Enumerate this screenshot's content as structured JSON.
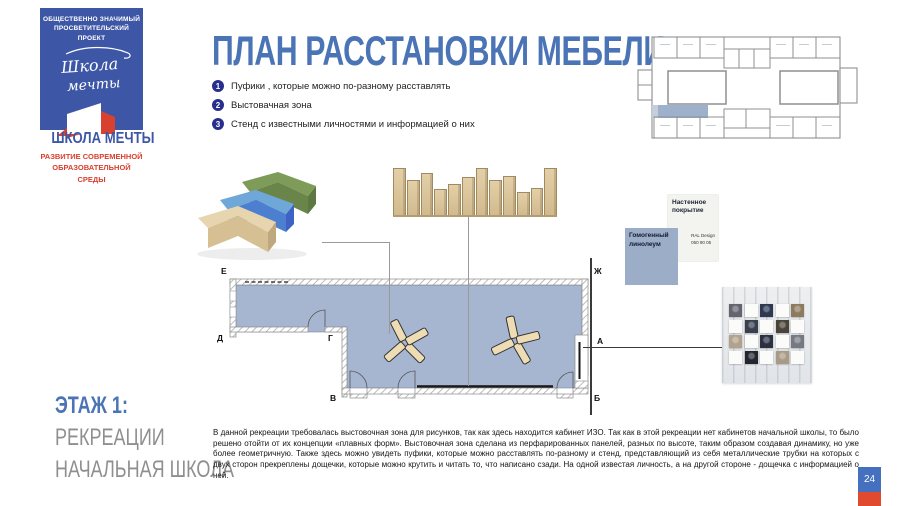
{
  "slide": {
    "page_number": "24"
  },
  "logo": {
    "project_line1": "ОБЩЕСТВЕННО ЗНАЧИМЫЙ",
    "project_line2": "ПРОСВЕТИТЕЛЬСКИЙ ПРОЕКТ",
    "script_line1": "Школа",
    "script_line2": "мечты",
    "name": "ШКОЛА МЕЧТЫ",
    "tagline_line1": "РАЗВИТИЕ СОВРЕМЕННОЙ",
    "tagline_line2": "ОБРАЗОВАТЕЛЬНОЙ СРЕДЫ"
  },
  "title": "ПЛАН РАССТАНОВКИ МЕБЕЛИ",
  "legend": {
    "items": [
      {
        "num": "1",
        "label": "Пуфики , которые можно по-разному расставлять"
      },
      {
        "num": "2",
        "label": "Выстовачная зона"
      },
      {
        "num": "3",
        "label": "Стенд с  известными личностями и информацией о них"
      }
    ]
  },
  "plan": {
    "axis_labels": {
      "E": "Е",
      "D": "Д",
      "G": "Г",
      "V": "В",
      "ZH": "Ж",
      "A": "А",
      "B": "Б"
    }
  },
  "materials": {
    "wall_covering": {
      "title": "Настенное покрытие",
      "spec_line1": "RAL Design",
      "spec_line2": "050 90 05"
    },
    "floor": {
      "title": "Гомогенный линолеум"
    }
  },
  "floor_label": {
    "floor": "ЭТАЖ 1:",
    "line1": "РЕКРЕАЦИИ",
    "line2": "НАЧАЛЬНАЯ ШКОЛА"
  },
  "description": "В данной рекреации требовалась выстовочная зона для рисунков, так как здесь находится кабинет ИЗО. Так как в этой рекреации нет кабинетов начальной школы, то было решено отойти от их концепции «плавных форм». Выстовочная зона сделана из перфарированных панелей, разных по высоте, таким образом создавая динамику, но уже более геометричную. Также здесь можно увидеть пуфики, которые можно расставлять по-разному и стенд, представляющий из себя металлические трубки на которых с двух сторон прекреплены дощечки, которые можно крутить и читать то, что написано сзади. На одной известая личность, а на другой стороне - дощечка с информацией о ней.",
  "exhibition_wall": {
    "slat_heights": [
      0.95,
      0.7,
      0.85,
      0.53,
      0.63,
      0.78,
      0.96,
      0.71,
      0.79,
      0.45,
      0.55,
      0.96
    ]
  },
  "photo_stand": {
    "tiles": [
      [
        "#63646e",
        "",
        "#2e3850",
        "",
        "#8d7b60"
      ],
      [
        "",
        "#3a3f4d",
        "",
        "#4a4438",
        ""
      ],
      [
        "#b0a28c",
        "",
        "#2c3142",
        "",
        "#757a82"
      ],
      [
        "",
        "#23262e",
        "",
        "#a89a84",
        ""
      ]
    ]
  },
  "colors": {
    "accent_blue": "#4a74b5",
    "logo_blue": "#3d57a6",
    "logo_red": "#d8402f",
    "plan_fill": "#a7b6d0",
    "badge_navy": "#272e8e",
    "gray_text": "#8f8f8f",
    "page_badge_blue": "#4570c0",
    "page_badge_red": "#e04a2e"
  }
}
